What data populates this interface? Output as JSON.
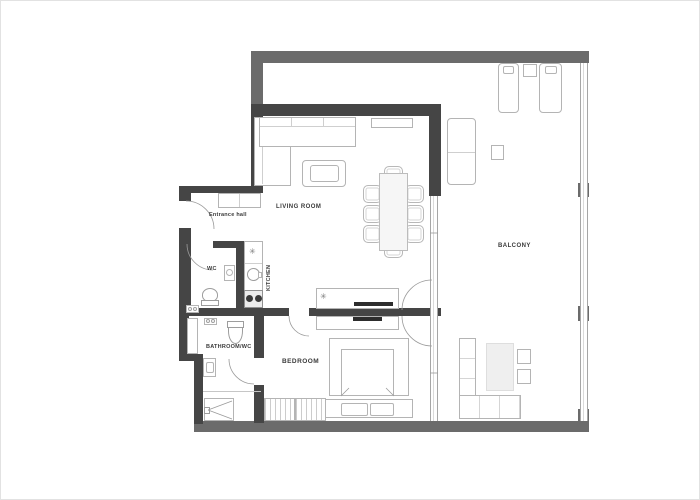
{
  "title": "Apartment floor plan",
  "rooms": {
    "living_room": "LIVING ROOM",
    "balcony": "BALCONY",
    "entrance_hall": "Entrance hall",
    "wc": "WC",
    "kitchen": "KITCHEN",
    "bathroom_wc": "BATHROOM/WC",
    "bedroom": "BEDROOM"
  },
  "icons": {
    "hob_star": "✳"
  },
  "colors": {
    "wall_interior": "#454545",
    "wall_exterior": "#6b6b6b",
    "furniture_outline": "#b4b4b4",
    "glass_line": "#a6a6a6",
    "tv_bar": "#2d2d2d",
    "label_text": "#3a3a3a",
    "background": "#ffffff"
  },
  "furniture": {
    "living_room": [
      "corner-sofa",
      "coffee-table",
      "sideboard",
      "dining-table",
      "dining-chairs-x8",
      "media-console-with-tv"
    ],
    "kitchen": [
      "fridge",
      "round-sink",
      "cooktop-2-burners"
    ],
    "entrance_hall": [
      "closet"
    ],
    "wc": [
      "toilet",
      "washbasin"
    ],
    "bathroom_wc": [
      "toilet",
      "washbasin",
      "shower",
      "shelf",
      "washer-fixtures"
    ],
    "bedroom": [
      "double-bed",
      "pillows-x2",
      "wardrobe-hanging",
      "dresser-with-tv"
    ],
    "balcony": [
      "sun-lounger-x2",
      "side-table-x4",
      "bench",
      "corner-sofa",
      "rug"
    ]
  }
}
